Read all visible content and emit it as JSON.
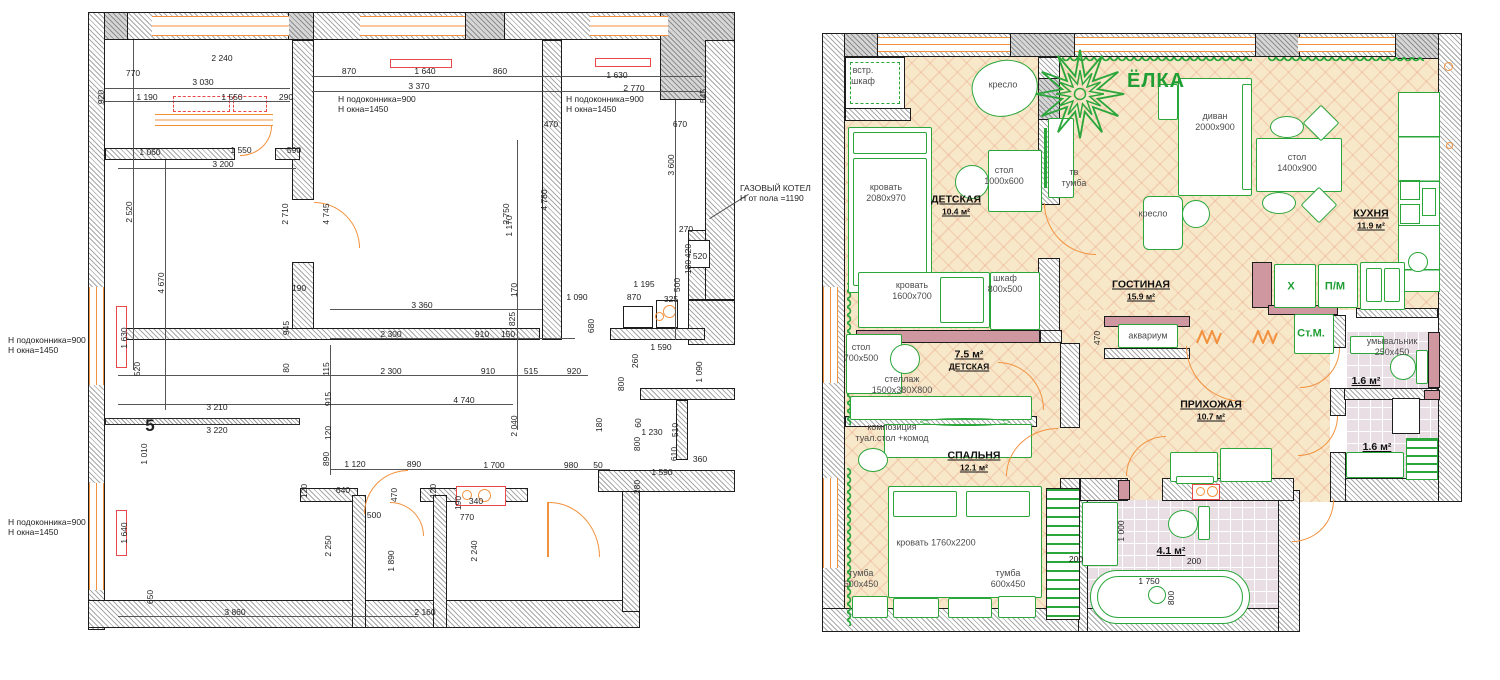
{
  "title": "Обмерный план и план расстановки мебели",
  "colors": {
    "accent_orange": "#f2913d",
    "furniture_green": "#2aa63a",
    "radiator_red": "#e9484b",
    "floor_beige": "#f8e8ca",
    "accent_wall_pink": "#cf98a0",
    "tile_lilac": "#e9dee4"
  },
  "left_plan": {
    "sheet_number": "5",
    "notes": [
      {
        "t": "Н подоконника=900\nН окна=1450",
        "x": 338,
        "y": 104,
        "a": "l"
      },
      {
        "t": "Н подоконника=900\nН окна=1450",
        "x": 566,
        "y": 104,
        "a": "l"
      },
      {
        "t": "Н подоконника=900\nН окна=1450",
        "x": 8,
        "y": 345,
        "a": "l"
      },
      {
        "t": "Н подоконника=900\nН окна=1450",
        "x": 8,
        "y": 527,
        "a": "l"
      },
      {
        "t": "ГАЗОВЫЙ КОТЕЛ\nН от пола =1190",
        "x": 740,
        "y": 193,
        "a": "l"
      }
    ],
    "dims": [
      {
        "t": "770",
        "x": 133,
        "y": 73
      },
      {
        "t": "2 240",
        "x": 222,
        "y": 58
      },
      {
        "t": "3 030",
        "x": 203,
        "y": 82
      },
      {
        "t": "920",
        "x": 101,
        "y": 97,
        "v": 1
      },
      {
        "t": "1 190",
        "x": 147,
        "y": 97
      },
      {
        "t": "1 550",
        "x": 232,
        "y": 97
      },
      {
        "t": "290",
        "x": 286,
        "y": 97
      },
      {
        "t": "870",
        "x": 349,
        "y": 71
      },
      {
        "t": "1 640",
        "x": 425,
        "y": 71
      },
      {
        "t": "3 370",
        "x": 419,
        "y": 86
      },
      {
        "t": "860",
        "x": 500,
        "y": 71
      },
      {
        "t": "470",
        "x": 551,
        "y": 124
      },
      {
        "t": "1 630",
        "x": 617,
        "y": 75
      },
      {
        "t": "2 770",
        "x": 634,
        "y": 88
      },
      {
        "t": "670",
        "x": 680,
        "y": 124
      },
      {
        "t": "545",
        "x": 703,
        "y": 96,
        "v": 1
      },
      {
        "t": "1 170",
        "x": 509,
        "y": 226,
        "v": 1
      },
      {
        "t": "2 520",
        "x": 129,
        "y": 212,
        "v": 1
      },
      {
        "t": "4 670",
        "x": 161,
        "y": 283,
        "v": 1
      },
      {
        "t": "1 630",
        "x": 124,
        "y": 338,
        "v": 1
      },
      {
        "t": "1 640",
        "x": 124,
        "y": 533,
        "v": 1
      },
      {
        "t": "1 060",
        "x": 150,
        "y": 152
      },
      {
        "t": "1 550",
        "x": 241,
        "y": 150
      },
      {
        "t": "590",
        "x": 294,
        "y": 150
      },
      {
        "t": "3 200",
        "x": 223,
        "y": 164
      },
      {
        "t": "2 710",
        "x": 285,
        "y": 214,
        "v": 1
      },
      {
        "t": "4 745",
        "x": 326,
        "y": 214,
        "v": 1
      },
      {
        "t": "2 750",
        "x": 506,
        "y": 214,
        "v": 1
      },
      {
        "t": "4 780",
        "x": 544,
        "y": 200,
        "v": 1
      },
      {
        "t": "3 600",
        "x": 671,
        "y": 165,
        "v": 1
      },
      {
        "t": "520",
        "x": 137,
        "y": 369,
        "v": 1
      },
      {
        "t": "3 210",
        "x": 217,
        "y": 407
      },
      {
        "t": "3 220",
        "x": 217,
        "y": 430
      },
      {
        "t": "5",
        "x": 150,
        "y": 426,
        "big": 1
      },
      {
        "t": "1 010",
        "x": 144,
        "y": 454,
        "v": 1
      },
      {
        "t": "650",
        "x": 150,
        "y": 597,
        "v": 1
      },
      {
        "t": "3 860",
        "x": 235,
        "y": 612
      },
      {
        "t": "2 160",
        "x": 425,
        "y": 612
      },
      {
        "t": "190",
        "x": 299,
        "y": 288
      },
      {
        "t": "3 360",
        "x": 422,
        "y": 305
      },
      {
        "t": "825",
        "x": 512,
        "y": 319,
        "v": 1
      },
      {
        "t": "170",
        "x": 514,
        "y": 290,
        "v": 1
      },
      {
        "t": "2 300",
        "x": 391,
        "y": 334
      },
      {
        "t": "910",
        "x": 482,
        "y": 334
      },
      {
        "t": "150",
        "x": 508,
        "y": 334
      },
      {
        "t": "945",
        "x": 286,
        "y": 328,
        "v": 1
      },
      {
        "t": "80",
        "x": 286,
        "y": 368,
        "v": 1
      },
      {
        "t": "115",
        "x": 326,
        "y": 369,
        "v": 1
      },
      {
        "t": "2 300",
        "x": 391,
        "y": 371
      },
      {
        "t": "910",
        "x": 488,
        "y": 371
      },
      {
        "t": "515",
        "x": 531,
        "y": 371
      },
      {
        "t": "920",
        "x": 574,
        "y": 371
      },
      {
        "t": "915",
        "x": 328,
        "y": 399,
        "v": 1
      },
      {
        "t": "4 740",
        "x": 464,
        "y": 400
      },
      {
        "t": "2 040",
        "x": 514,
        "y": 426,
        "v": 1
      },
      {
        "t": "120",
        "x": 328,
        "y": 433,
        "v": 1
      },
      {
        "t": "890",
        "x": 326,
        "y": 459,
        "v": 1
      },
      {
        "t": "1 090",
        "x": 577,
        "y": 297
      },
      {
        "t": "870",
        "x": 634,
        "y": 297
      },
      {
        "t": "325",
        "x": 671,
        "y": 299
      },
      {
        "t": "1 195",
        "x": 644,
        "y": 284
      },
      {
        "t": "680",
        "x": 591,
        "y": 326,
        "v": 1
      },
      {
        "t": "260",
        "x": 635,
        "y": 361,
        "v": 1
      },
      {
        "t": "800",
        "x": 621,
        "y": 384,
        "v": 1
      },
      {
        "t": "1 590",
        "x": 661,
        "y": 347
      },
      {
        "t": "1 090",
        "x": 699,
        "y": 372,
        "v": 1
      },
      {
        "t": "180",
        "x": 599,
        "y": 425,
        "v": 1
      },
      {
        "t": "60",
        "x": 638,
        "y": 423,
        "v": 1
      },
      {
        "t": "1 230",
        "x": 652,
        "y": 432
      },
      {
        "t": "510",
        "x": 675,
        "y": 430,
        "v": 1
      },
      {
        "t": "800",
        "x": 637,
        "y": 444,
        "v": 1
      },
      {
        "t": "610",
        "x": 674,
        "y": 454,
        "v": 1
      },
      {
        "t": "360",
        "x": 700,
        "y": 459
      },
      {
        "t": "1 590",
        "x": 662,
        "y": 472
      },
      {
        "t": "280",
        "x": 637,
        "y": 487,
        "v": 1
      },
      {
        "t": "1 120",
        "x": 355,
        "y": 464
      },
      {
        "t": "890",
        "x": 414,
        "y": 464
      },
      {
        "t": "1 700",
        "x": 494,
        "y": 465
      },
      {
        "t": "980",
        "x": 571,
        "y": 465
      },
      {
        "t": "50",
        "x": 598,
        "y": 465
      },
      {
        "t": "120",
        "x": 304,
        "y": 491,
        "v": 1
      },
      {
        "t": "640",
        "x": 343,
        "y": 490
      },
      {
        "t": "470",
        "x": 394,
        "y": 495,
        "v": 1
      },
      {
        "t": "500",
        "x": 374,
        "y": 515
      },
      {
        "t": "2 250",
        "x": 328,
        "y": 546,
        "v": 1
      },
      {
        "t": "1 890",
        "x": 391,
        "y": 561,
        "v": 1
      },
      {
        "t": "120",
        "x": 433,
        "y": 491,
        "v": 1
      },
      {
        "t": "190",
        "x": 458,
        "y": 503,
        "v": 1
      },
      {
        "t": "340",
        "x": 476,
        "y": 501
      },
      {
        "t": "770",
        "x": 467,
        "y": 517
      },
      {
        "t": "2 240",
        "x": 474,
        "y": 551,
        "v": 1
      },
      {
        "t": "270",
        "x": 686,
        "y": 229
      },
      {
        "t": "520",
        "x": 700,
        "y": 256
      },
      {
        "t": "420",
        "x": 688,
        "y": 251,
        "v": 1
      },
      {
        "t": "180",
        "x": 688,
        "y": 267,
        "v": 1
      },
      {
        "t": "500",
        "x": 677,
        "y": 285,
        "v": 1
      }
    ]
  },
  "right_plan": {
    "rooms": [
      {
        "l1": "ДЕТСКАЯ",
        "l2": "10.4 м²",
        "x": 956,
        "y": 205
      },
      {
        "l1": "ГОСТИНАЯ",
        "l2": "15.9 м²",
        "x": 1141,
        "y": 290
      },
      {
        "l1": "КУХНЯ",
        "l2": "11.9 м²",
        "x": 1371,
        "y": 219
      },
      {
        "l1": "7.5 м²",
        "l2": "ДЕТСКАЯ",
        "x": 969,
        "y": 360
      },
      {
        "l1": "СПАЛЬНЯ",
        "l2": "12.1 м²",
        "x": 974,
        "y": 461
      },
      {
        "l1": "ПРИХОЖАЯ",
        "l2": "10.7 м²",
        "x": 1211,
        "y": 410
      },
      {
        "l1": "1.6 м²",
        "l2": "",
        "x": 1366,
        "y": 381
      },
      {
        "l1": "1.6 м²",
        "l2": "",
        "x": 1377,
        "y": 447
      },
      {
        "l1": "4.1 м²",
        "l2": "",
        "x": 1171,
        "y": 551
      }
    ],
    "furniture_labels": [
      {
        "t": "встр.\nшкаф",
        "x": 863,
        "y": 76
      },
      {
        "t": "кресло",
        "x": 1003,
        "y": 85
      },
      {
        "t": "диван\n2000х900",
        "x": 1215,
        "y": 122
      },
      {
        "t": "стол\n1400х900",
        "x": 1297,
        "y": 163
      },
      {
        "t": "стол\n1000х600",
        "x": 1004,
        "y": 176
      },
      {
        "t": "тв\nтумба",
        "x": 1074,
        "y": 178
      },
      {
        "t": "кровать\n2080х970",
        "x": 886,
        "y": 193
      },
      {
        "t": "кресло",
        "x": 1153,
        "y": 214
      },
      {
        "t": "кровать\n1600х700",
        "x": 912,
        "y": 291
      },
      {
        "t": "шкаф\n800х500",
        "x": 1005,
        "y": 284
      },
      {
        "t": "аквариум",
        "x": 1148,
        "y": 336
      },
      {
        "t": "стол\n700х500",
        "x": 861,
        "y": 353
      },
      {
        "t": "стеллаж\n1500х380Х800",
        "x": 902,
        "y": 385
      },
      {
        "t": "композиция\nтуал.стол +комод",
        "x": 892,
        "y": 433
      },
      {
        "t": "кровать 1760х2200",
        "x": 936,
        "y": 543
      },
      {
        "t": "тумба\n600х450",
        "x": 861,
        "y": 579
      },
      {
        "t": "тумба\n600х450",
        "x": 1008,
        "y": 579
      },
      {
        "t": "умывальник\n250х450",
        "x": 1392,
        "y": 347
      },
      {
        "t": "ЁЛКА",
        "x": 1156,
        "y": 81,
        "g": 1,
        "tree": 1
      },
      {
        "t": "Х",
        "x": 1291,
        "y": 287,
        "g": 1
      },
      {
        "t": "П/М",
        "x": 1335,
        "y": 287,
        "g": 1
      },
      {
        "t": "Ст.М.",
        "x": 1311,
        "y": 334,
        "g": 1
      }
    ],
    "dims": [
      {
        "t": "470",
        "x": 1097,
        "y": 338,
        "v": 1
      },
      {
        "t": "1 000",
        "x": 1121,
        "y": 531,
        "v": 1
      },
      {
        "t": "200",
        "x": 1076,
        "y": 559
      },
      {
        "t": "200",
        "x": 1194,
        "y": 561
      },
      {
        "t": "1 750",
        "x": 1149,
        "y": 581
      },
      {
        "t": "800",
        "x": 1171,
        "y": 598,
        "v": 1
      }
    ]
  }
}
